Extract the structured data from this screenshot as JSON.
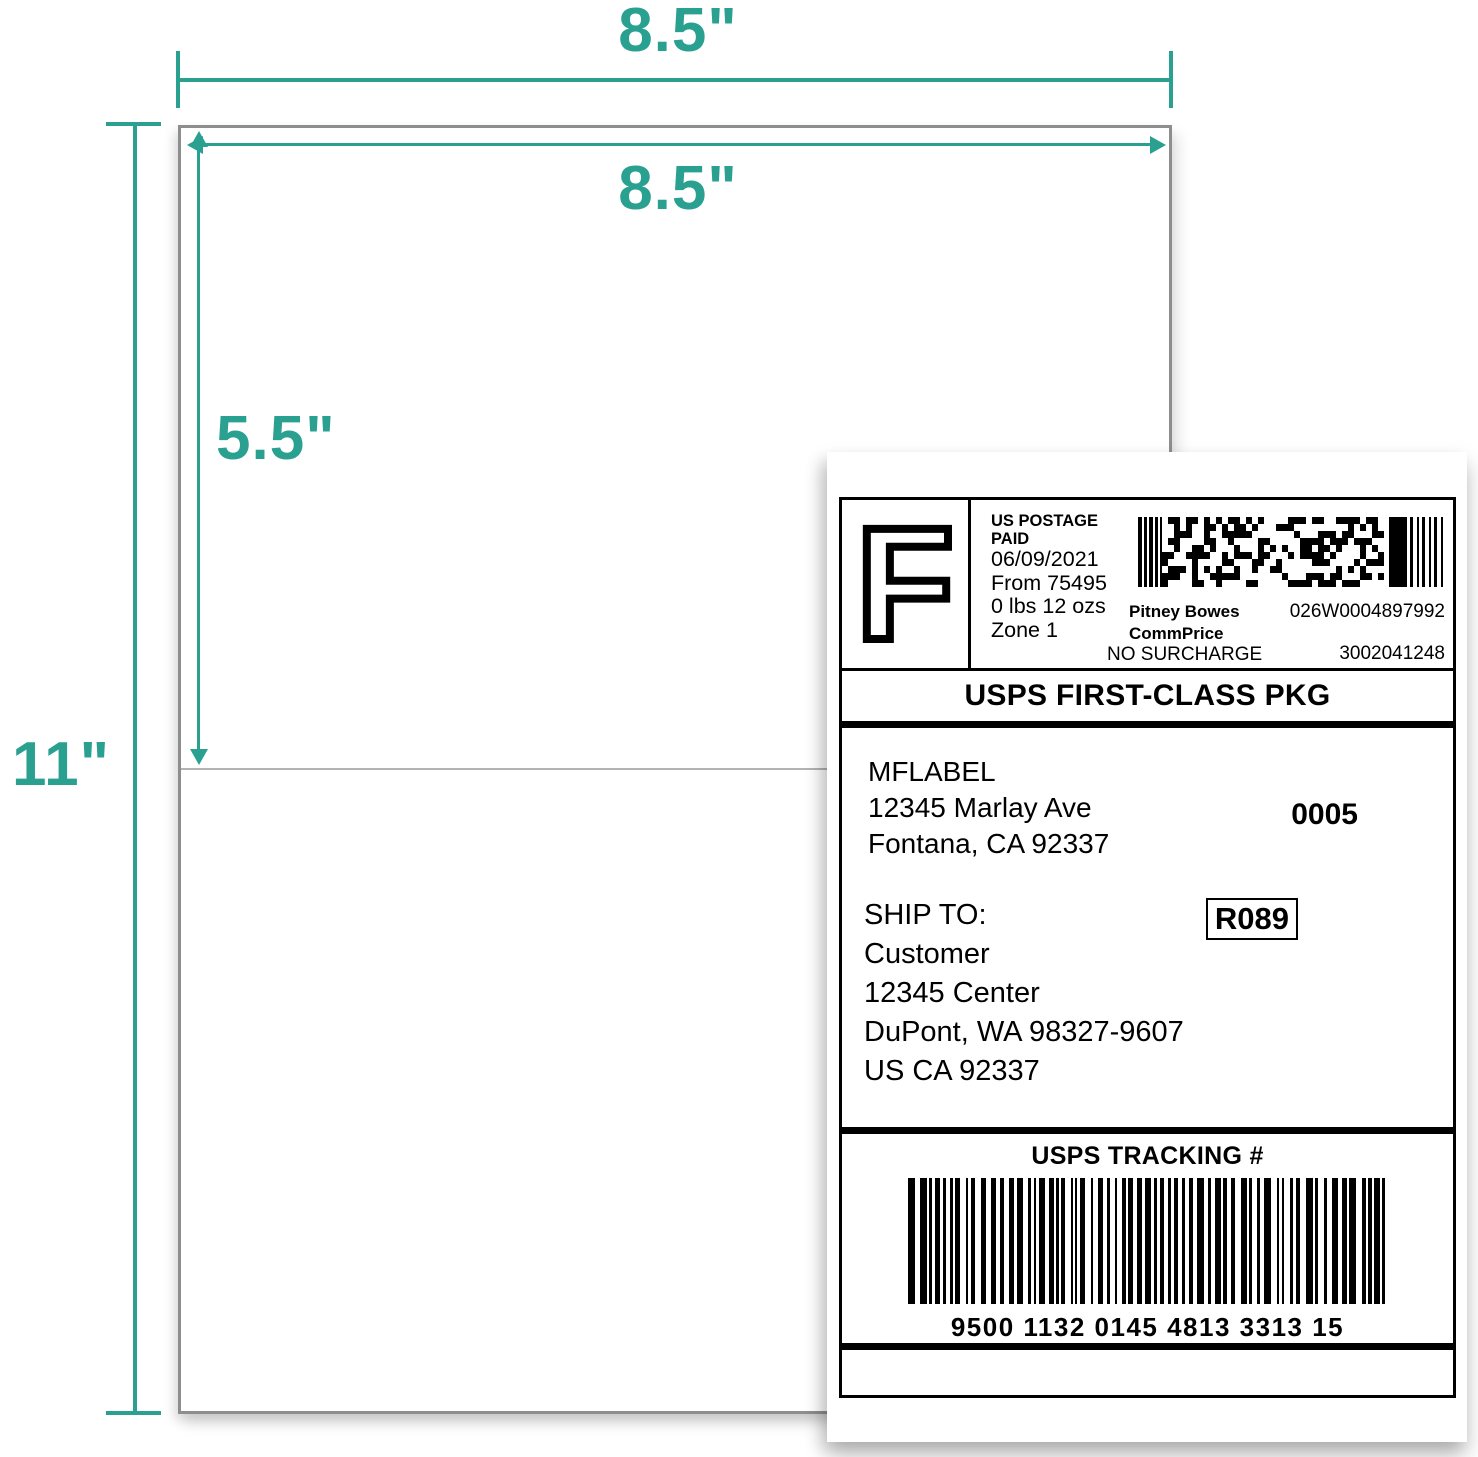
{
  "colors": {
    "accent": "#2aa090",
    "sheet_border": "#8e8e8e",
    "divider": "#b3b3b3",
    "label_ink": "#000000"
  },
  "annotations": {
    "sheet_width": "8.5\"",
    "label_width": "8.5\"",
    "label_height": "5.5\"",
    "sheet_height": "11\""
  },
  "label": {
    "stamp_letter": "F",
    "postage": {
      "line1": "US POSTAGE",
      "line2": "PAID",
      "line3": "06/09/2021",
      "line4": "From 75495",
      "line5": "0 lbs 12 ozs",
      "line6": "Zone 1"
    },
    "meter": {
      "carrier": "Pitney Bowes",
      "meter_number": "026W0004897992",
      "rate_code": "CommPrice",
      "surcharge": "NO SURCHARGE",
      "account_number": "3002041248"
    },
    "service": "USPS FIRST-CLASS PKG",
    "sender": {
      "line1": "MFLABEL",
      "line2": "12345 Marlay Ave",
      "line3": "Fontana, CA 92337",
      "ref": "0005"
    },
    "ship_to": {
      "heading": "SHIP TO:",
      "line1": "Customer",
      "line2": "12345 Center",
      "line3": "DuPont, WA 98327-9607",
      "line4": "US CA 92337",
      "zone": "R089"
    },
    "tracking": {
      "heading": "USPS TRACKING #",
      "number": "9500 1132 0145 4813 3313 15"
    }
  }
}
